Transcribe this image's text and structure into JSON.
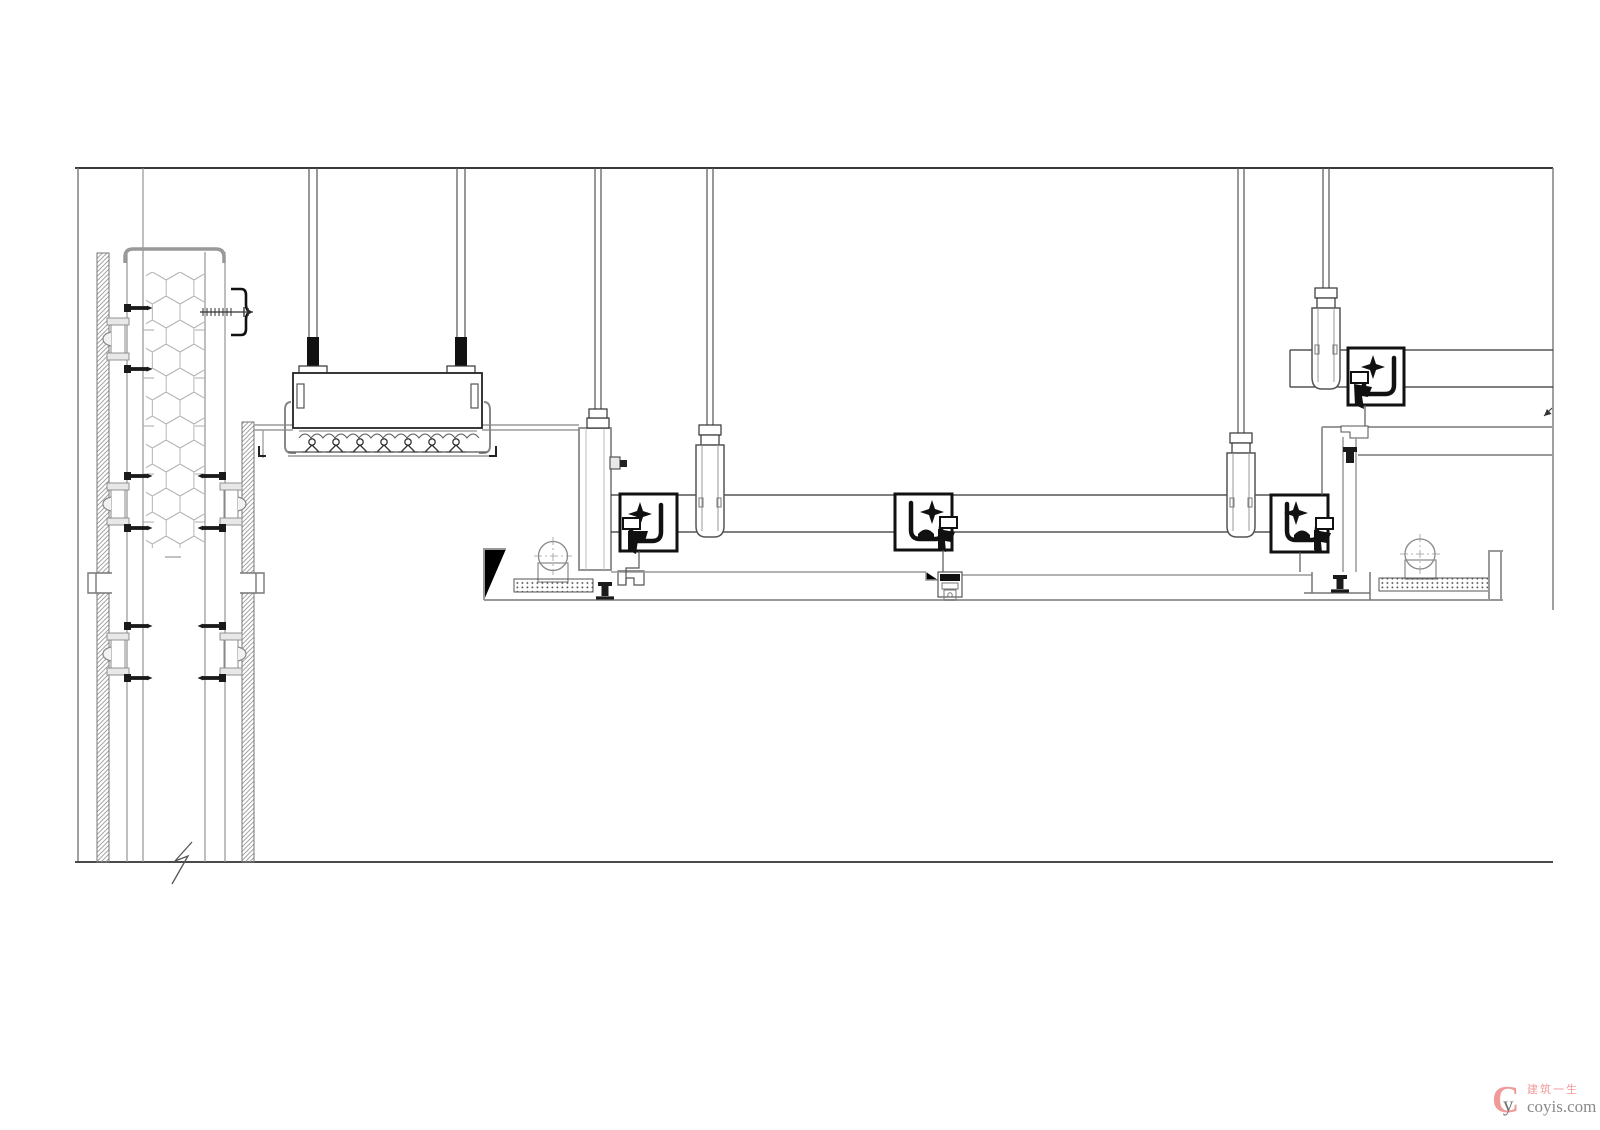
{
  "watermark": {
    "logo_c": "C",
    "logo_y": "y",
    "tagline": "建筑一生",
    "site": "coyis.com"
  },
  "palette": {
    "background": "#ffffff",
    "line_dark": "#333333",
    "line_medium": "#777777",
    "line_light": "#999999",
    "clip_black": "#111111",
    "hatch_gray": "#9a9a9a",
    "hex_gray": "#b5b5b5",
    "watermark_pink": "#f09a9a",
    "watermark_gray": "#8a8a8a"
  }
}
